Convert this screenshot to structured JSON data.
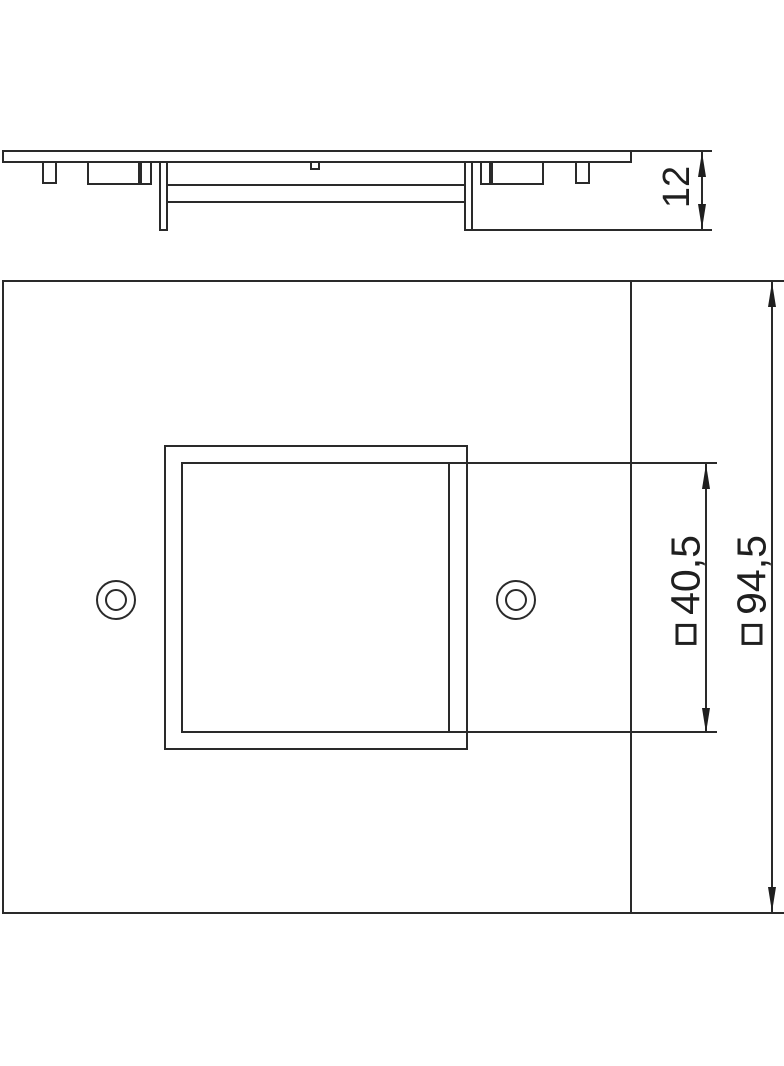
{
  "drawing": {
    "background_color": "#ffffff",
    "line_color": "#2a2a2a",
    "side_view": {
      "description": "profile-view-of-cover-plate",
      "dimension_height": {
        "value": "12"
      }
    },
    "front_view": {
      "description": "front-view-of-square-cover-plate-with-square-cutout-and-two-screw-holes",
      "dimension_cutout": {
        "symbol": "□",
        "value": "40,5"
      },
      "dimension_plate": {
        "symbol": "□",
        "value": "94,5"
      }
    }
  }
}
